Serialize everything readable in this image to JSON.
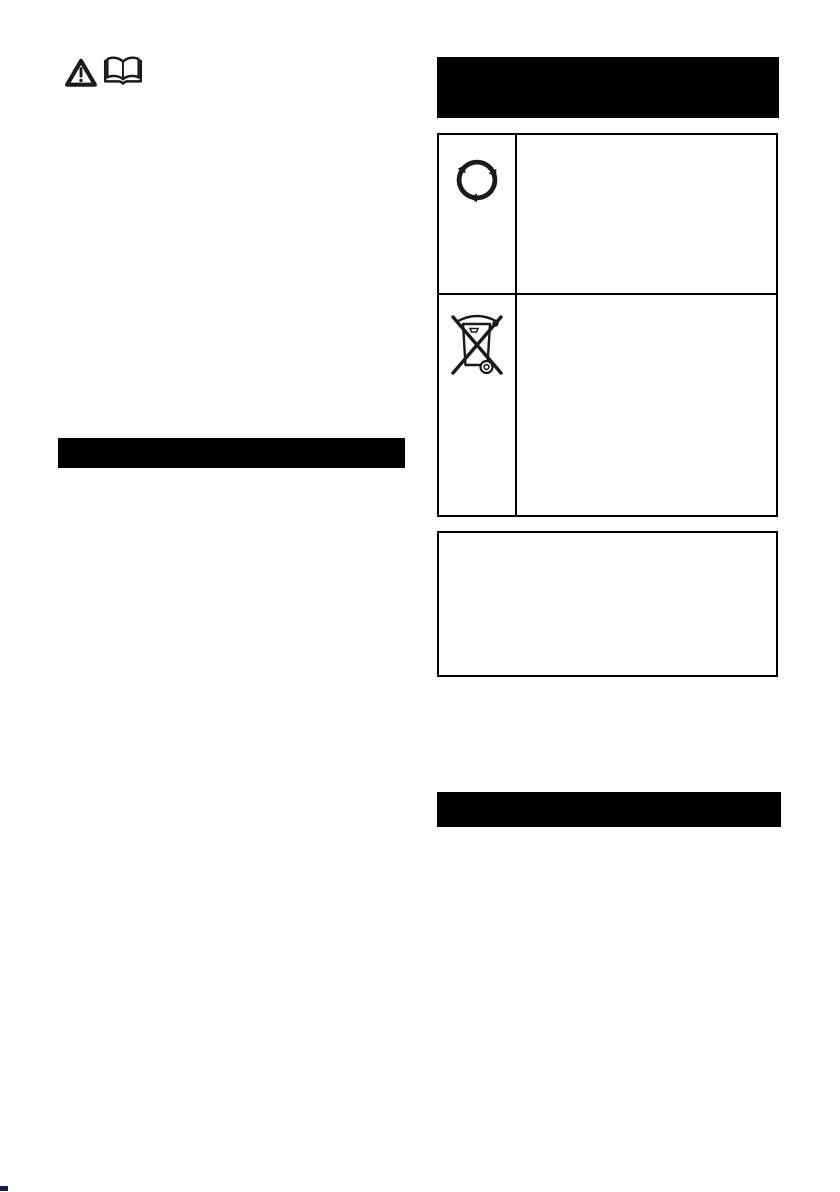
{
  "page": {
    "background": "#ffffff",
    "bar_color": "#000000",
    "icon_color": "#1a1a1a",
    "border_color": "#000000"
  },
  "top_icons": {
    "warning": "warning-triangle",
    "manual": "open-book"
  },
  "left_column": {
    "section_bar_label": ""
  },
  "right_column": {
    "header_bar_label": "",
    "table": {
      "rows": [
        {
          "icon": "recycling-symbol",
          "text": ""
        },
        {
          "icon": "crossed-out-wheelie-bin",
          "text": ""
        }
      ]
    },
    "note_box_text": "",
    "section_bar_label": ""
  },
  "footer": {
    "corner_mark_color": "#181c3a"
  }
}
